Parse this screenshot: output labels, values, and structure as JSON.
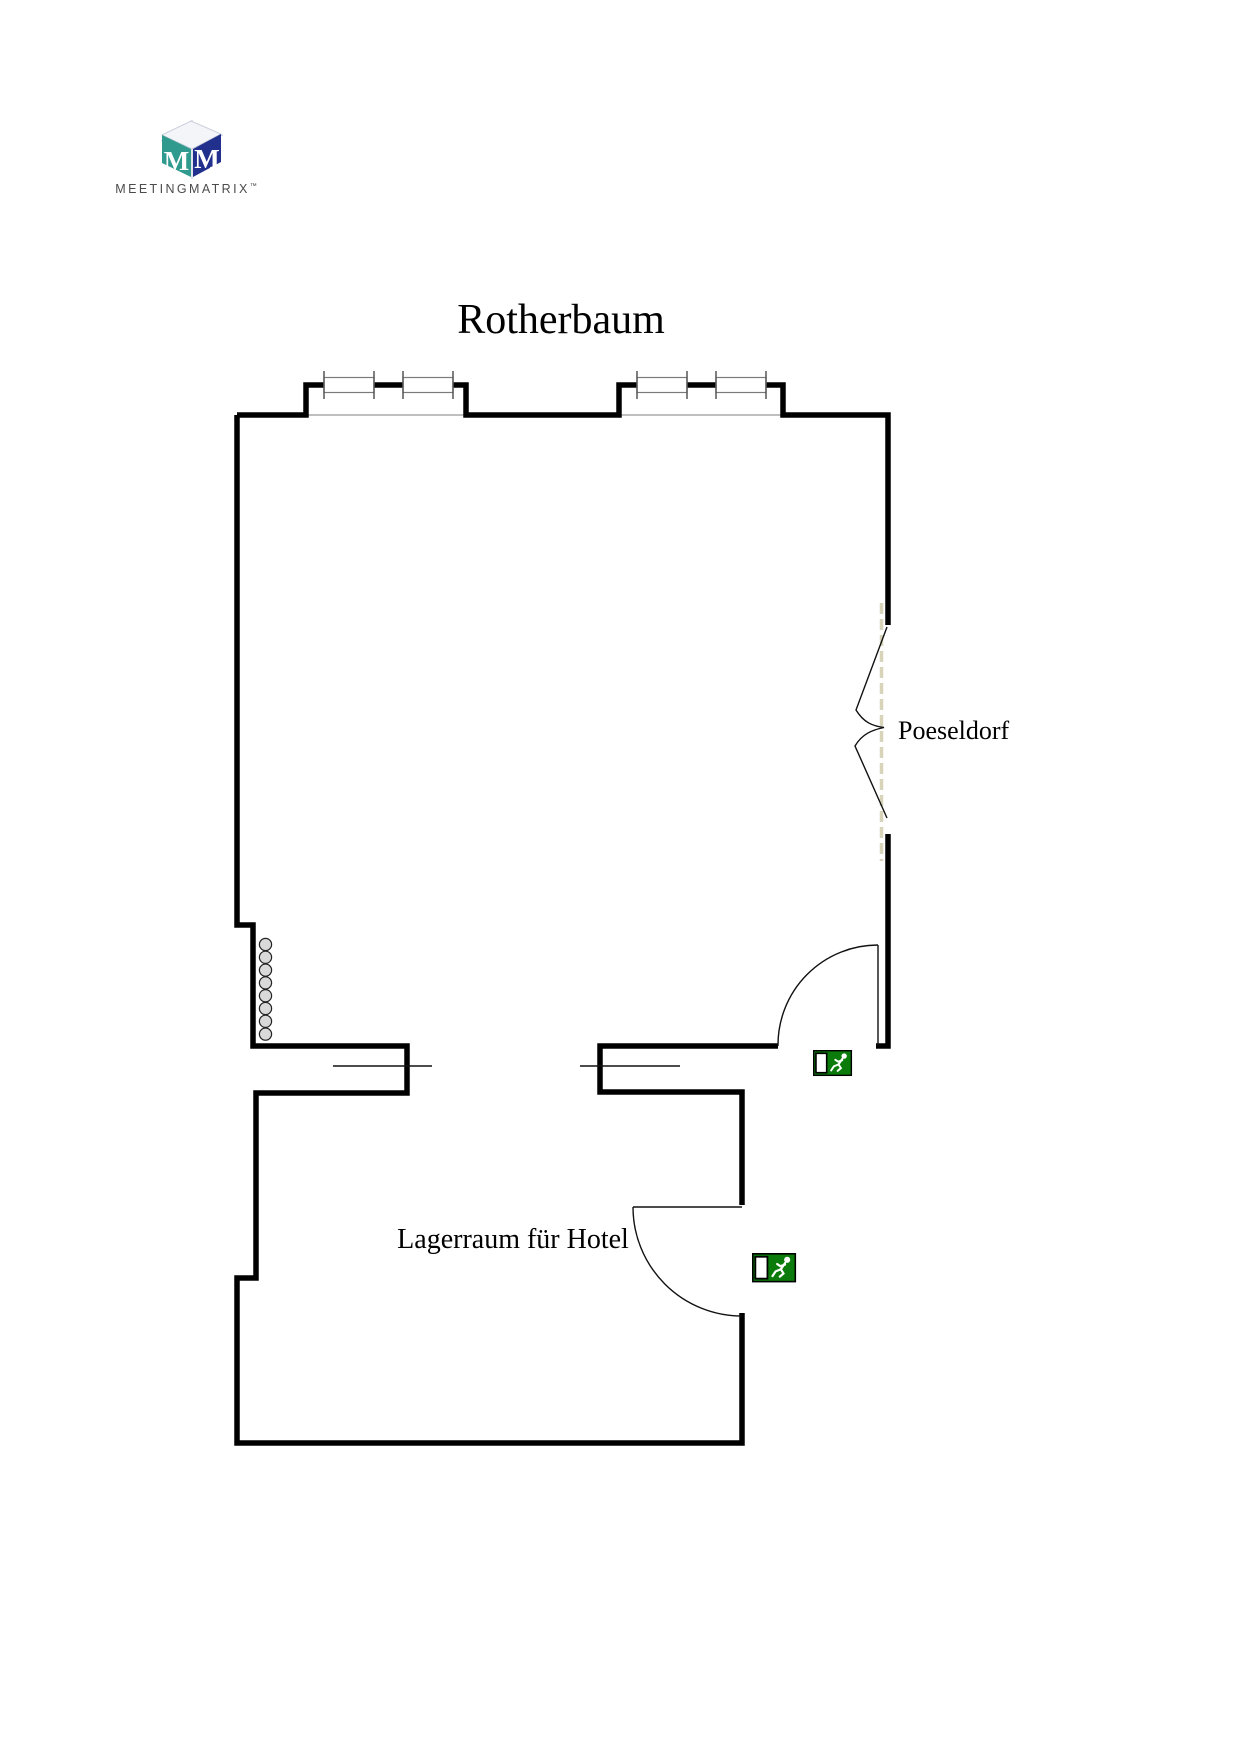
{
  "logo": {
    "brand": "MEETINGMATRIX",
    "tm": "™",
    "letter_left": "M",
    "letter_right": "M",
    "colors": {
      "left_face": "#2f9a8d",
      "right_face": "#20308c",
      "top_face": "#f4f5f9",
      "letter": "#ffffff",
      "text": "#4b4b4b"
    }
  },
  "plan": {
    "title": "Rotherbaum",
    "labels": {
      "adjacent_space": "Poeseldorf",
      "lower_room": "Lagerraum für Hotel"
    },
    "colors": {
      "wall": "#000000",
      "dashed_opening": "#d8d4ba",
      "bumper_fill": "#d9d9d9",
      "exit_green": "#0b7c0b"
    },
    "icons": {
      "exit_sign_upper": "exit-sign-icon",
      "exit_sign_lower": "exit-sign-icon"
    }
  }
}
